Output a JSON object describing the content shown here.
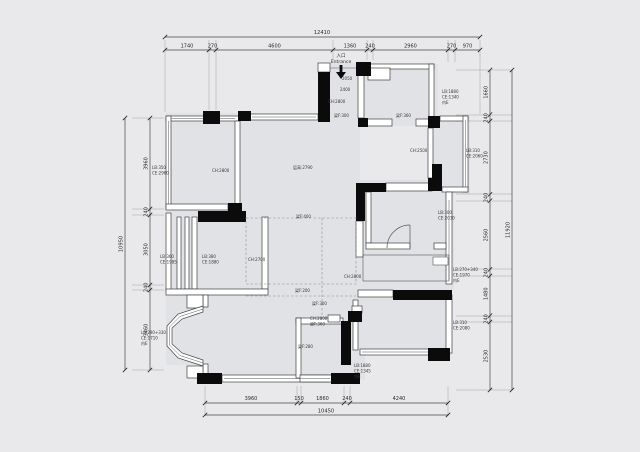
{
  "title": "apartment floor plan",
  "colors": {
    "background": "#e9e9eb",
    "floor": "#e1e2e5",
    "wall_black": "#0b0b0c",
    "line": "#46464a"
  },
  "entrance": {
    "zh": "入口",
    "en": "Entrance"
  },
  "dims": {
    "top": {
      "total": "12410",
      "segments": [
        "1740",
        "270",
        "4600",
        "1360",
        "240",
        "2960",
        "270",
        "970"
      ]
    },
    "bottom": {
      "total": "10450",
      "segments": [
        "3960",
        "150",
        "1860",
        "240",
        "4240"
      ]
    },
    "left": {
      "total": "10950",
      "segments": [
        "3960",
        "240",
        "3050",
        "240",
        "3460"
      ]
    },
    "right": {
      "total": "11920",
      "segments": [
        "1660",
        "240",
        "2730",
        "240",
        "2560",
        "240",
        "1480",
        "240",
        "2530"
      ]
    }
  },
  "ann": {
    "entry_dim1": "2050",
    "entry_dim2": "2400",
    "entry_ch": "CH:2800",
    "beam_entry": "梁F:300",
    "beam_kitchen": "梁F:360",
    "tr_room": [
      "LB:1880",
      "CE:1340",
      "内E"
    ],
    "balcony_tl_ch": "CH:2800",
    "left_top": [
      "LB:350",
      "CE:2960"
    ],
    "living_ch": "层高:2790",
    "kitchen_ch": "CH:2500",
    "right_balcony": [
      "LB:310",
      "CE:2060"
    ],
    "bath": [
      "LB:300",
      "CE:2030"
    ],
    "left_mid_a": [
      "LB:360",
      "CE:1985"
    ],
    "left_mid_b": [
      "LB:380",
      "CE:1880"
    ],
    "mid_room_ch": "CH:2700",
    "bay": [
      "LB:290+330",
      "CE:1710",
      "内E"
    ],
    "beam_living": "梁F:400",
    "beam_dining1": "梁F:200",
    "beam_dining2": "梁F:300",
    "dining_pair": [
      "CH:2800",
      "梁F:360"
    ],
    "dining_ch": "CH:2800",
    "beam_bed": "梁F:280",
    "bed_mid": [
      "LB:1880",
      "CE:1345",
      "内E"
    ],
    "right_mid": [
      "LB:270+340",
      "CE:1970",
      "内E"
    ],
    "right_low": [
      "LB:310",
      "CE:2080"
    ]
  }
}
